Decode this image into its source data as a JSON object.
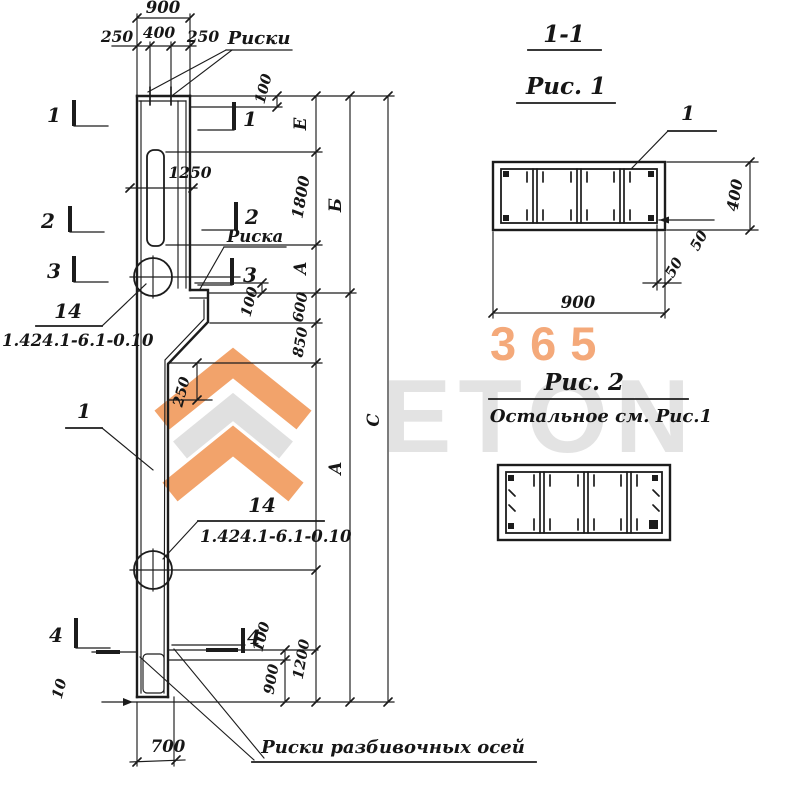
{
  "watermark": {
    "number": "365",
    "brand": "ETON"
  },
  "titles": {
    "section": "1-1",
    "fig1": "Рис. 1",
    "fig2": "Рис. 2",
    "fig2_note": "Остальное см. Рис.1"
  },
  "elevation": {
    "notes": {
      "riski_top": "Риски",
      "riska": "Риска",
      "pos1": "1",
      "mark14": "14",
      "series_ref": "1.424.1-6.1-0.10",
      "axes": "Риски разбивочных осей"
    },
    "marks": {
      "s1": "1",
      "s2": "2",
      "s3": "3",
      "s4": "4"
    },
    "dims": {
      "top_900": "900",
      "top_250l": "250",
      "top_400": "400",
      "top_250r": "250",
      "d100_top": "100",
      "d1250": "1250",
      "E": "Е",
      "d1800": "1800",
      "A_up": "А",
      "d600": "600",
      "d850": "850",
      "d100_mid": "100",
      "d250": "250",
      "B": "Б",
      "A_low": "А",
      "C": "С",
      "d100_bot": "100",
      "d900_bot": "900",
      "d1200": "1200",
      "d10": "10",
      "d700": "700"
    }
  },
  "fig1": {
    "pos": "1",
    "w": "900",
    "h": "400",
    "c50a": "50",
    "c50b": "50"
  }
}
